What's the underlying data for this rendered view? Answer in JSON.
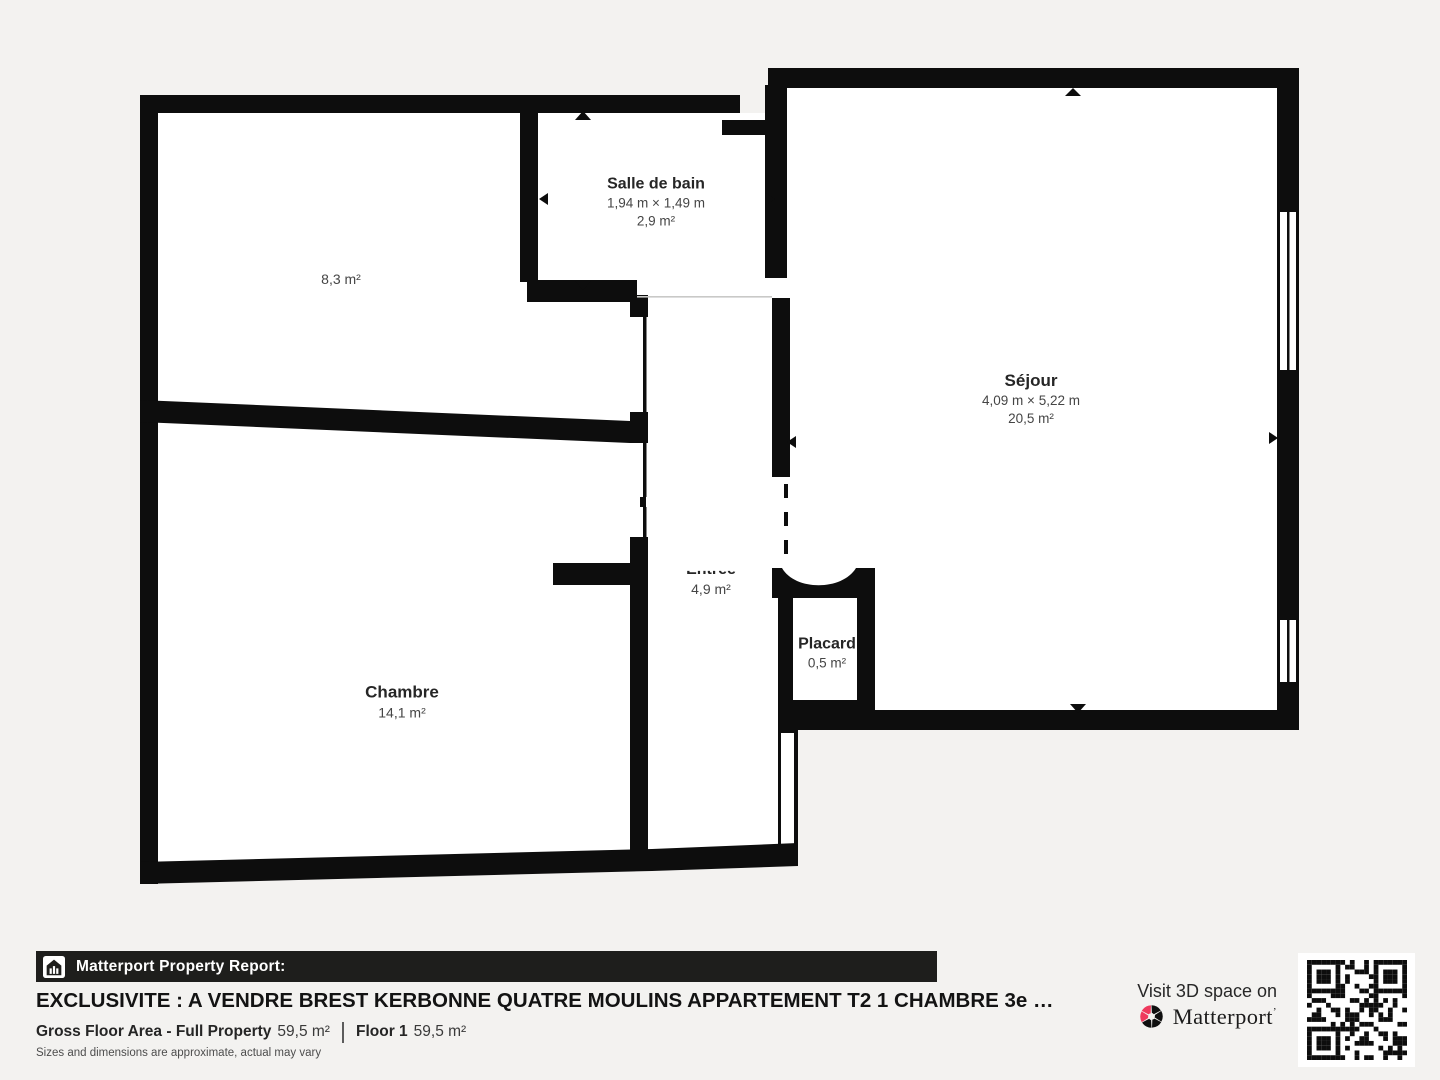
{
  "page": {
    "background": "#f3f2f0"
  },
  "floorplan": {
    "wall_color": "#0d0d0d",
    "floor_color": "#ffffff",
    "rooms": [
      {
        "id": "room-8-3",
        "area": "8,3 m²"
      },
      {
        "id": "salle-de-bain",
        "name": "Salle de bain",
        "dimensions": "1,94 m × 1,49 m",
        "area": "2,9 m²"
      },
      {
        "id": "sejour",
        "name": "Séjour",
        "dimensions": "4,09 m × 5,22 m",
        "area": "20,5 m²"
      },
      {
        "id": "chambre",
        "name": "Chambre",
        "area": "14,1 m²"
      },
      {
        "id": "entree",
        "name": "Entrée",
        "area": "4,9 m²"
      },
      {
        "id": "placard",
        "name": "Placard",
        "area": "0,5 m²"
      }
    ]
  },
  "footer": {
    "report_bar": {
      "label": "Matterport Property Report:",
      "bg": "#1e1e1c",
      "icon": "house-bars-icon"
    },
    "listing_title": "EXCLUSIVITE : A VENDRE BREST KERBONNE QUATRE MOULINS APPARTEMENT T2 1 CHAMBRE 3e …",
    "gross_floor_area_label": "Gross Floor Area - Full Property",
    "gross_floor_area_value": "59,5 m²",
    "floor_label": "Floor 1",
    "floor_value": "59,5 m²",
    "disclaimer": "Sizes and dimensions are approximate, actual may vary",
    "cta": {
      "line": "Visit 3D space on",
      "brand": "Matterport",
      "brand_tick": "’",
      "brand_color": "#ef3a5d",
      "qr": "qr-code"
    }
  }
}
